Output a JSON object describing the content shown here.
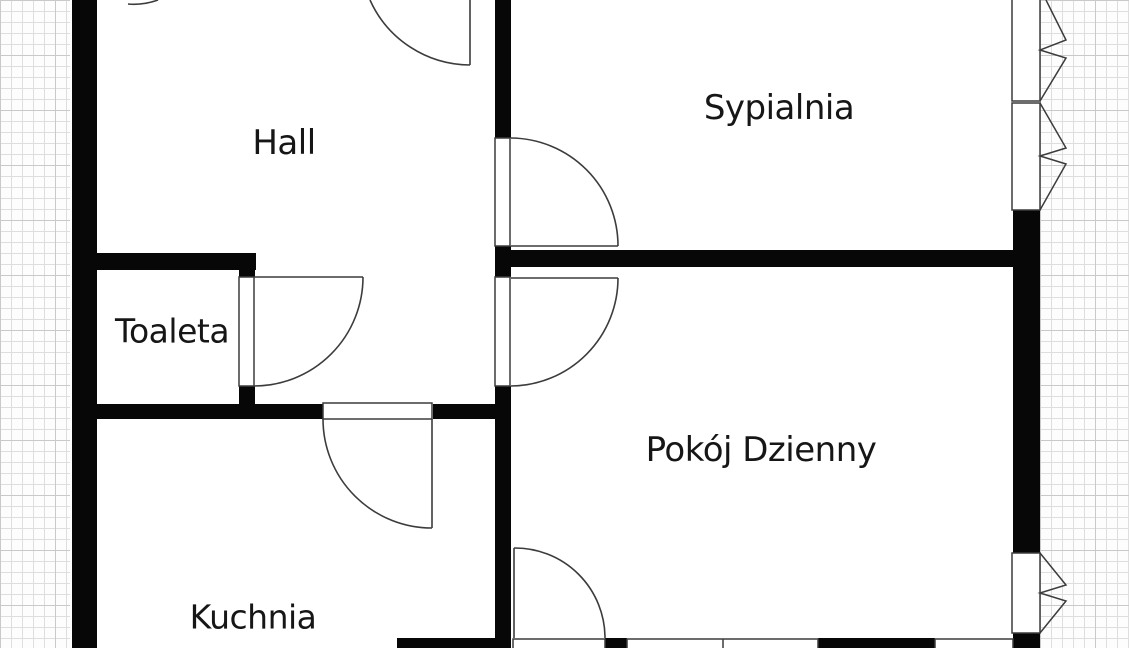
{
  "meta": {
    "type": "apartment-floor-plan",
    "language": "pl"
  },
  "colors": {
    "wall": "#070707",
    "line": "#3c3c3c",
    "background": "#ffffff",
    "grid_minor": "#dedede",
    "grid_major": "#c9c9c9",
    "label_text": "#161616"
  },
  "grid": {
    "minor_spacing_px": 11,
    "major_spacing_px": 55
  },
  "rooms": [
    {
      "id": "hall",
      "label": "Hall"
    },
    {
      "id": "sypialnia",
      "label": "Sypialnia"
    },
    {
      "id": "toaleta",
      "label": "Toaleta"
    },
    {
      "id": "pokoj-dzienny",
      "label": "Pokój Dzienny"
    },
    {
      "id": "kuchnia",
      "label": "Kuchnia"
    }
  ],
  "doors": [
    {
      "id": "entry-door-top",
      "between": "outside / hall (cut off at top)"
    },
    {
      "id": "upper-left-door",
      "between": "hall (arc fragment at top edge)"
    },
    {
      "id": "toaleta-door",
      "between": "hall / toaleta"
    },
    {
      "id": "sypialnia-door",
      "between": "hall / sypialnia"
    },
    {
      "id": "pokoj-dzienny-door",
      "between": "hall / pokój dzienny"
    },
    {
      "id": "kuchnia-door",
      "between": "hall / kuchnia"
    },
    {
      "id": "balcony-door",
      "between": "pokój dzienny / outside (bottom wall)"
    }
  ],
  "windows": [
    {
      "id": "sypialnia-window-1",
      "wall": "right"
    },
    {
      "id": "sypialnia-window-2",
      "wall": "right"
    },
    {
      "id": "pokoj-window-right",
      "wall": "right"
    },
    {
      "id": "pokoj-window-bottom-1",
      "wall": "bottom"
    },
    {
      "id": "pokoj-window-bottom-2",
      "wall": "bottom"
    }
  ]
}
